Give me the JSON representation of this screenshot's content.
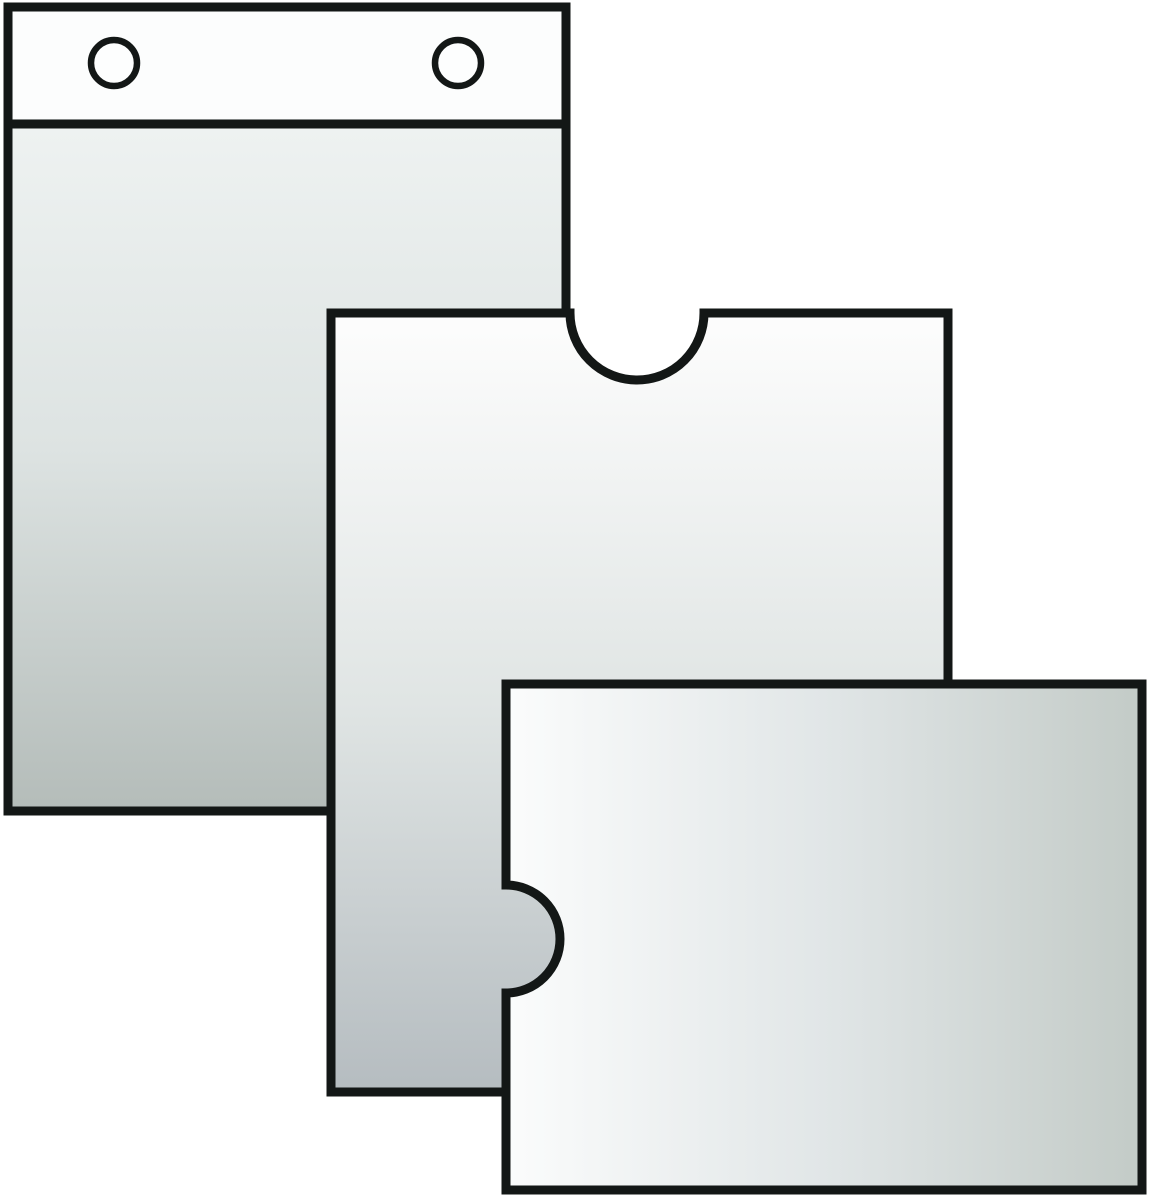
{
  "illustration": {
    "background": "#ffffff",
    "outline_color": "#131716",
    "shapes": {
      "hanging_pocket": {
        "label": "hanging-pocket-with-punch-holes",
        "header_fill": "#fcfdfd",
        "hole_fill": "#fdfefe",
        "gradient_top": "#f7faf9",
        "gradient_upper": "#eef2f1",
        "gradient_mid": "#dde3e2",
        "gradient_bottom": "#b4bcb9"
      },
      "portrait_pocket": {
        "label": "portrait-pocket-with-top-thumb-notch",
        "gradient_top": "#fdfdfd",
        "gradient_mid": "#e0e5e4",
        "gradient_bottom": "#b5bcc0"
      },
      "landscape_pocket": {
        "label": "landscape-pocket-with-left-thumb-notch",
        "gradient_left": "#fbfcfc",
        "gradient_mid": "#e1e6e7",
        "gradient_right": "#c3cbc7"
      }
    }
  }
}
